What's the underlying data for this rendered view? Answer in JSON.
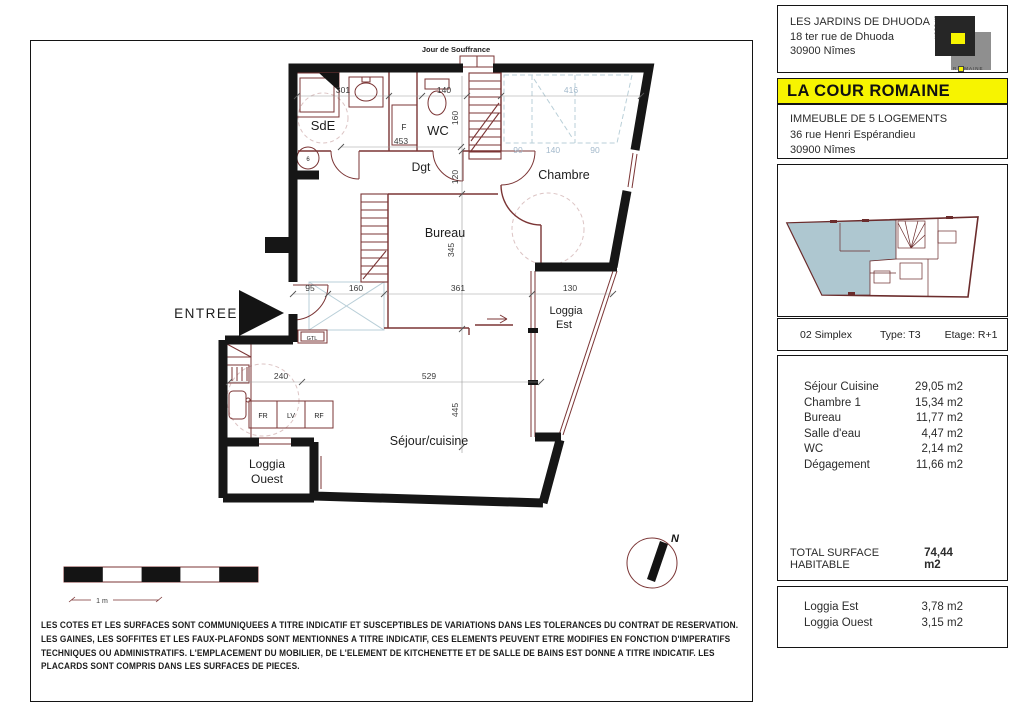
{
  "plan": {
    "top_label": "Jour de Souffrance",
    "entree_label": "ENTREE",
    "compass_n": "N",
    "scale_label": "1 m",
    "rooms": {
      "sde": "SdE",
      "wc": "WC",
      "dgt": "Dgt",
      "chambre": "Chambre",
      "bureau": "Bureau",
      "loggia_est_1": "Loggia",
      "loggia_est_2": "Est",
      "sejour": "Séjour/cuisine",
      "loggia_ouest_1": "Loggia",
      "loggia_ouest_2": "Ouest"
    },
    "appliances": {
      "fr": "FR",
      "lv": "LV",
      "rf": "RF",
      "gtl": "GTL",
      "f": "F",
      "heater": "6"
    },
    "dims": {
      "d301": "301",
      "d140": "140",
      "d416": "416",
      "d453": "453",
      "d90a": "90",
      "d140b": "140",
      "d90b": "90",
      "d160": "160",
      "d120": "120",
      "d345": "345",
      "d445": "445",
      "d95": "95",
      "d160b": "160",
      "d361": "361",
      "d130": "130",
      "d240": "240",
      "d529": "529"
    }
  },
  "sidebar": {
    "project": {
      "name": "LES JARDINS DE DHUODA",
      "street": "18 ter rue de Dhuoda",
      "city": "30900 Nîmes"
    },
    "logo": {
      "side": "LA COUR",
      "bottom_left": "R",
      "bottom_right": "MAINE"
    },
    "residence_name": "LA COUR ROMAINE",
    "building": {
      "line1": "IMMEUBLE DE 5 LOGEMENTS",
      "line2": "36 rue Henri Espérandieu",
      "line3": "30900 Nîmes"
    },
    "unit": {
      "number": "02 Simplex",
      "type": "Type: T3",
      "floor": "Etage: R+1"
    },
    "areas": [
      {
        "label": "Séjour Cuisine",
        "value": "29,05 m2"
      },
      {
        "label": "Chambre 1",
        "value": "15,34 m2"
      },
      {
        "label": "Bureau",
        "value": "11,77 m2"
      },
      {
        "label": "Salle d'eau",
        "value": "4,47 m2"
      },
      {
        "label": "WC",
        "value": "2,14 m2"
      },
      {
        "label": "Dégagement",
        "value": "11,66 m2"
      }
    ],
    "total": {
      "label": "TOTAL SURFACE HABITABLE",
      "value": "74,44 m2"
    },
    "loggias": [
      {
        "label": "Loggia Est",
        "value": "3,78 m2"
      },
      {
        "label": "Loggia Ouest",
        "value": "3,15 m2"
      }
    ],
    "colors": {
      "accent_yellow": "#f7f400",
      "plan_line": "#7b3535",
      "thumb_fill": "#aec7d0"
    }
  },
  "disclaimer": "LES COTES ET LES SURFACES SONT COMMUNIQUEES A TITRE INDICATIF ET SUSCEPTIBLES DE VARIATIONS DANS LES TOLERANCES DU CONTRAT DE RESERVATION. LES GAINES, LES SOFFITES ET LES FAUX-PLAFONDS SONT MENTIONNES A TITRE INDICATIF, CES ELEMENTS PEUVENT ETRE MODIFIES EN FONCTION D'IMPERATIFS TECHNIQUES OU ADMINISTRATIFS. L'EMPLACEMENT DU MOBILIER, DE L'ELEMENT DE KITCHENETTE ET DE SALLE DE BAINS EST DONNE A TITRE INDICATIF. LES PLACARDS SONT COMPRIS DANS LES SURFACES DE PIECES."
}
